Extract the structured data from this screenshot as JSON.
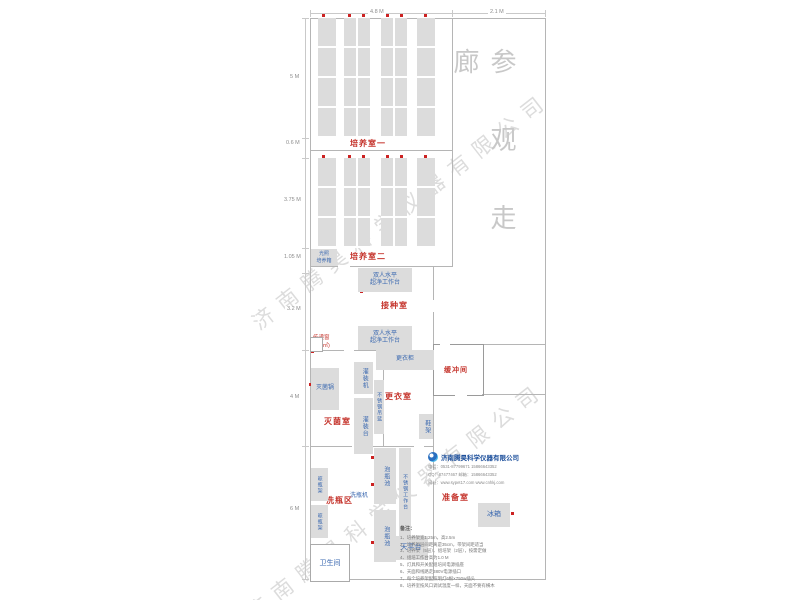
{
  "watermark": {
    "text": "济南腾昊科学仪器有限公司"
  },
  "corridor": {
    "text": "参观走廊"
  },
  "dimensions": {
    "top": {
      "d1": "4.8 M",
      "d2": "2.1 M"
    },
    "left": {
      "d1": "5 M",
      "d2": "0.6 M",
      "d3": "3.75 M",
      "d4": "1.05 M",
      "d5": "3.2 M",
      "d6": "4 M",
      "d7": "6 M"
    }
  },
  "rooms": {
    "peiyang1": "培养室一",
    "peiyang2": "培养室二",
    "jiezhong": "接种室",
    "chuandi": "传递窗",
    "chuandi_area": "(0.6㎡)",
    "miejun": "灭菌室",
    "gengyi": "更衣室",
    "huanchong": "缓冲间",
    "xipingqu": "洗瓶区",
    "zhunbei": "准备室",
    "weisheng": "卫生间"
  },
  "equipment": {
    "guangzhao_l1": "光照",
    "guangzhao_l2": "培养箱",
    "chaojing_l1": "双人水平",
    "chaojing_l2": "超净工作台",
    "gengyigui": "更衣柜",
    "miejunguo": "灭菌锅",
    "guanzhuangji": "灌装机",
    "guanzhuangtai": "灌装台",
    "diaolan": "不锈钢吊篮",
    "xiejia": "鞋架",
    "paopingchi": "泡瓶池",
    "gongzuotai": "不锈钢工作台",
    "xipingji": "洗瓶机",
    "liangpingjia": "晾瓶架",
    "tianpingtai": "天平台",
    "bingxiang": "冰箱"
  },
  "notes": {
    "heading": "备注：",
    "items": [
      "1、培养架宽1.25m，高2.5m",
      "2、培养架层间距离是35cm，带架间距适当",
      "3、培养架（5层）、组培架（2层），按需定做",
      "4、组培工作台高为1.0 M",
      "5、灯具和开关配组培间电源插座",
      "6、天面和线路走380V电源插口",
      "7、每个培养架配照明灯6根×750w插头",
      "8、培养室按风口调试温度一样，天面不要有横木"
    ]
  },
  "company": {
    "name": "济南腾昊科学仪器有限公司",
    "phone": "电话：0531-87799671  15866643352",
    "qq": "QQ：87477467  邮箱：15866643352",
    "web": "网址：www.sypet17.com  www.cnhkj.com"
  },
  "colors": {
    "wall": "#b5b5b5",
    "rack_fill": "#dcdcdc",
    "room_label": "#c5342c",
    "equipment_label": "#3a68b0",
    "outlet_dot": "#cc2222",
    "corridor_text": "#c8c8c8",
    "watermark": "#919191"
  }
}
